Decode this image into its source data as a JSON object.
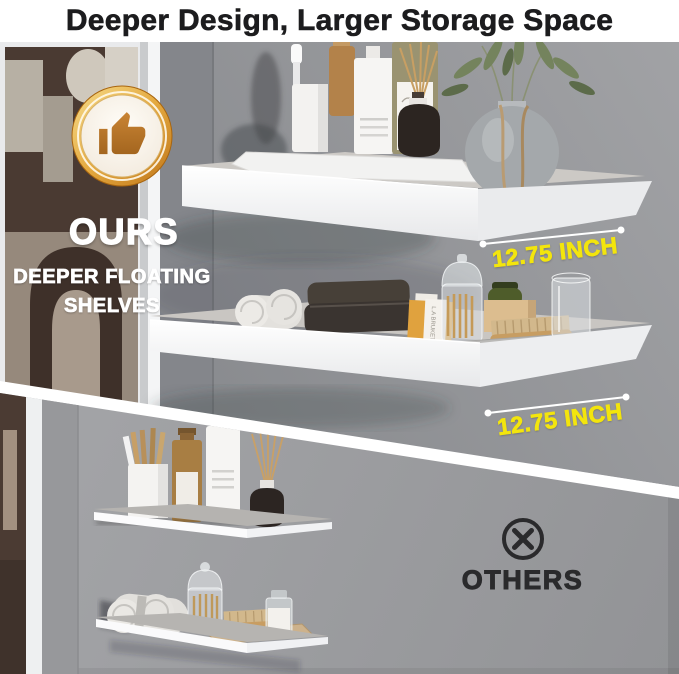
{
  "title": {
    "text": "Deeper Design, Larger Storage Space"
  },
  "ours_section": {
    "badge_icon": "thumbs-up-icon",
    "label": "OURS",
    "subtitle_line1": "DEEPER FLOATING",
    "subtitle_line2": "SHELVES",
    "measurements": {
      "top_shelf_depth": "12.75 INCH",
      "bottom_shelf_depth": "12.75 INCH"
    },
    "decor_items": {
      "soap_brand_label": "L.A BRUKET"
    }
  },
  "others_section": {
    "icon": "circle-x-icon",
    "label": "OTHERS"
  },
  "colors": {
    "accent_yellow": "#F3E50D",
    "title_text": "#1C1C1E",
    "ours_text": "#FFFFFF",
    "others_text": "#2A2A2C",
    "badge_gold": "#D98E2B",
    "badge_thumb_bronze": "#B5732B",
    "shelf_white": "#F7F7F8",
    "wall_gray_top": "#8E9093",
    "wall_gray_bottom": "#9B9C9F",
    "divider_white": "#FFFFFF"
  }
}
